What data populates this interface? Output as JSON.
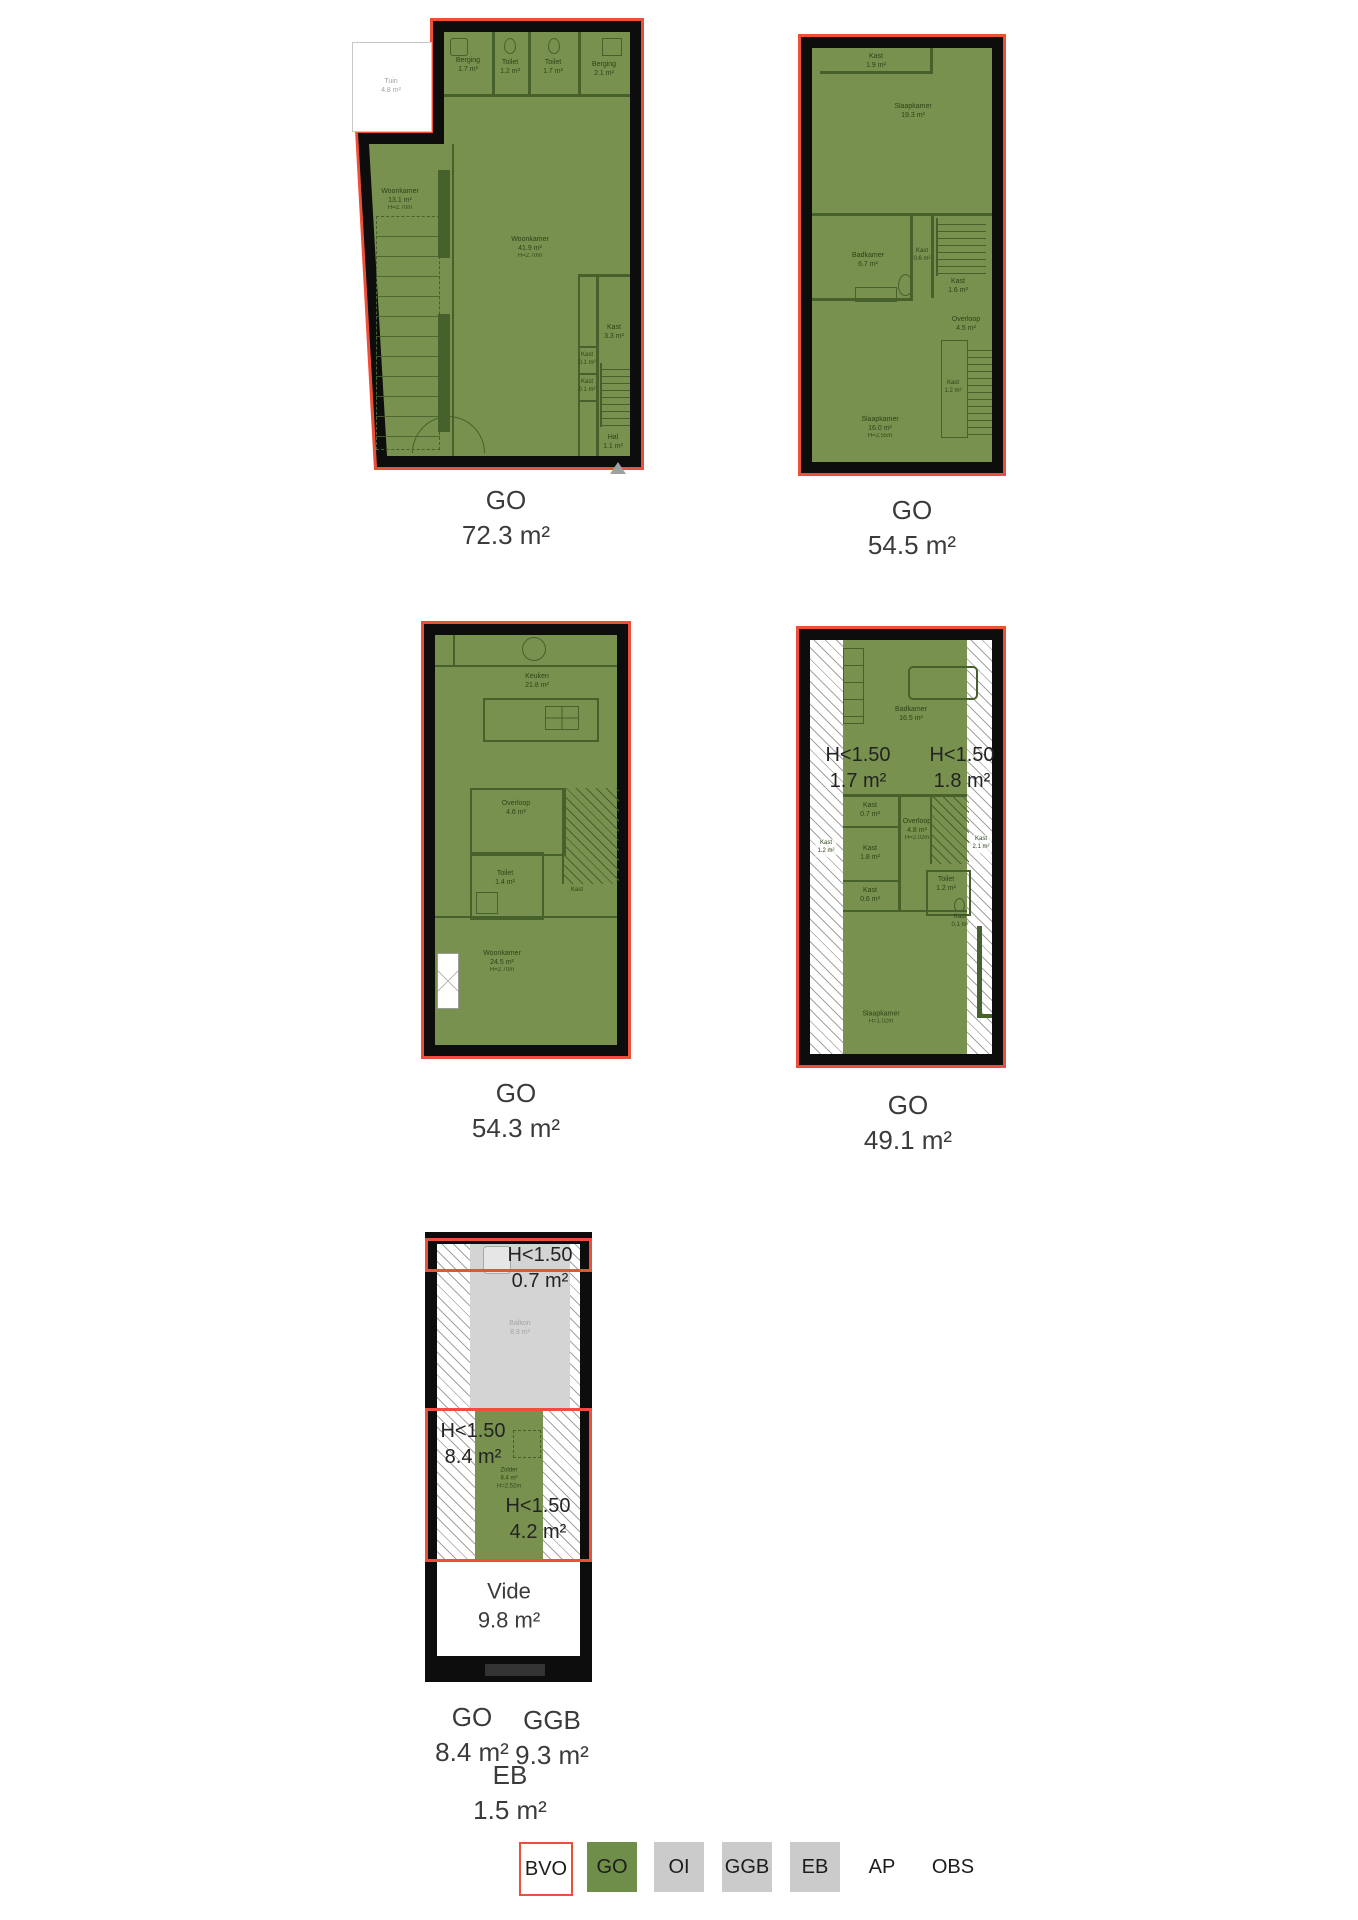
{
  "sheet": {
    "background": "#ffffff"
  },
  "colors": {
    "bvo_outline": "#ec4f3a",
    "go_fill": "#78914e",
    "go_legend": "#6f8e4a",
    "wall": "#0d0d0d",
    "oi_fill": "#d4d4d4",
    "legend_gray": "#cbcbcb",
    "interior_line": "#46612c"
  },
  "plans": {
    "p1": {
      "go": {
        "code": "GO",
        "area": "72.3 m²"
      },
      "rooms": {
        "tuin": {
          "name": "Tuin",
          "area": "4.8 m²"
        },
        "berging_a": {
          "name": "Berging",
          "area": "1.7 m²"
        },
        "toilet_a": {
          "name": "Toilet",
          "area": "1.2 m²"
        },
        "toilet_b": {
          "name": "Toilet",
          "area": "1.7 m²"
        },
        "berging_b": {
          "name": "Berging",
          "area": "2.1 m²"
        },
        "woonkamer_a": {
          "name": "Woonkamer",
          "area": "13.1 m²",
          "height": "H=2.70m"
        },
        "woonkamer_b": {
          "name": "Woonkamer",
          "area": "41.9 m²",
          "height": "H=2.70m"
        },
        "kast_a": {
          "name": "Kast",
          "area": "3.3 m²"
        },
        "kast_b": {
          "name": "Kast",
          "area": "0.1 m²"
        },
        "kast_c": {
          "name": "Kast",
          "area": "0.1 m²"
        },
        "hal": {
          "name": "Hal",
          "area": "1.1 m²"
        }
      }
    },
    "p2": {
      "go": {
        "code": "GO",
        "area": "54.5 m²"
      },
      "rooms": {
        "kast_a": {
          "name": "Kast",
          "area": "1.9 m²"
        },
        "slaapkamer_a": {
          "name": "Slaapkamer",
          "area": "19.3 m²"
        },
        "badkamer": {
          "name": "Badkamer",
          "area": "6.7 m²"
        },
        "kast_b": {
          "name": "Kast",
          "area": "0.6 m²"
        },
        "kast_c": {
          "name": "Kast",
          "area": "1.6 m²"
        },
        "overloop": {
          "name": "Overloop",
          "area": "4.5 m²"
        },
        "slaapkamer_b": {
          "name": "Slaapkamer",
          "area": "16.0 m²",
          "height": "H=2.55m"
        },
        "kast_d": {
          "name": "Kast",
          "area": "1.2 m²"
        }
      }
    },
    "p3": {
      "go": {
        "code": "GO",
        "area": "54.3 m²"
      },
      "rooms": {
        "keuken": {
          "name": "Keuken",
          "area": "21.8 m²"
        },
        "overloop": {
          "name": "Overloop",
          "area": "4.6 m²"
        },
        "toilet": {
          "name": "Toilet",
          "area": "1.4 m²"
        },
        "kast": {
          "name": "Kast"
        },
        "woonkamer": {
          "name": "Woonkamer",
          "area": "24.5 m²",
          "height": "H=2.70m"
        }
      }
    },
    "p4": {
      "go": {
        "code": "GO",
        "area": "49.1 m²"
      },
      "h_left": {
        "line1": "H<1.50",
        "line2": "1.7 m²"
      },
      "h_right": {
        "line1": "H<1.50",
        "line2": "1.8 m²"
      },
      "rooms": {
        "badkamer": {
          "name": "Badkamer",
          "area": "16.5 m²"
        },
        "kast_a": {
          "name": "Kast",
          "area": "0.7 m²"
        },
        "kast_b": {
          "name": "Kast",
          "area": "1.2 m²"
        },
        "kast_c": {
          "name": "Kast",
          "area": "1.8 m²"
        },
        "kast_d": {
          "name": "Kast",
          "area": "0.6 m²"
        },
        "overloop": {
          "name": "Overloop",
          "area": "4.8 m²",
          "height": "H=2.02m"
        },
        "kast_e": {
          "name": "Kast",
          "area": "2.1 m²"
        },
        "toilet": {
          "name": "Toilet",
          "area": "1.2 m²"
        },
        "kast_f": {
          "name": "Kast",
          "area": "0.1 m²"
        },
        "slaapkamer": {
          "name": "Slaapkamer",
          "height": "H=1.02m"
        }
      }
    },
    "p5": {
      "h_top": {
        "line1": "H<1.50",
        "line2": "0.7 m²"
      },
      "h_mid": {
        "line1": "H<1.50",
        "line2": "8.4 m²"
      },
      "h_low": {
        "line1": "H<1.50",
        "line2": "4.2 m²"
      },
      "balkon": {
        "name": "Balkon",
        "area": "8.9 m²"
      },
      "zolder": {
        "name": "Zolder",
        "area": "8.4 m²",
        "height": "H=2.52m"
      },
      "vide": {
        "name": "Vide",
        "area": "9.8 m²"
      },
      "labels": {
        "go": {
          "code": "GO",
          "area": "8.4 m²"
        },
        "ggb": {
          "code": "GGB",
          "area": "9.3 m²"
        },
        "eb": {
          "code": "EB",
          "area": "1.5 m²"
        }
      }
    }
  },
  "legend": {
    "items": [
      {
        "label": "BVO",
        "style": "outline-red"
      },
      {
        "label": "GO",
        "style": "green"
      },
      {
        "label": "OI",
        "style": "gray"
      },
      {
        "label": "GGB",
        "style": "gray"
      },
      {
        "label": "EB",
        "style": "gray"
      },
      {
        "label": "AP",
        "style": "plain"
      },
      {
        "label": "OBS",
        "style": "plain"
      }
    ]
  }
}
